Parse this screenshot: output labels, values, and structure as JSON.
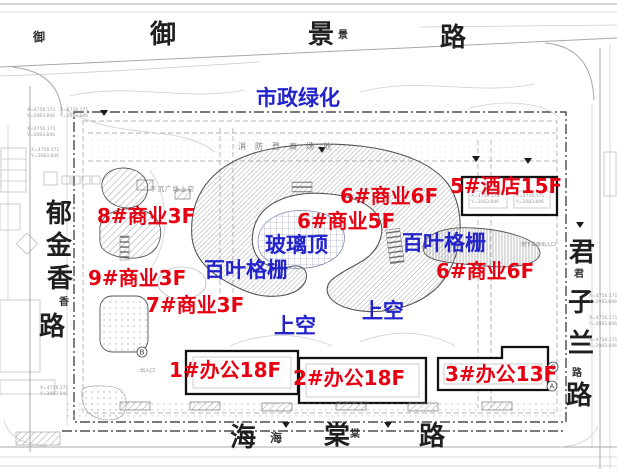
{
  "roads": {
    "top": {
      "chars": [
        "御",
        "景",
        "路"
      ],
      "small_prefix": "御",
      "small_mid": "景"
    },
    "left": {
      "chars": [
        "郁",
        "金",
        "香",
        "路"
      ],
      "small_mid": "香"
    },
    "right": {
      "chars": [
        "君",
        "子",
        "兰",
        "路"
      ],
      "small_top": "君",
      "small_bottom": "路"
    },
    "bottom": {
      "chars": [
        "海",
        "棠",
        "路"
      ],
      "small_hai": "海",
      "small_tang": "棠"
    }
  },
  "building_labels": [
    {
      "text": "8#商业3F"
    },
    {
      "text": "9#商业3F"
    },
    {
      "text": "7#商业3F"
    },
    {
      "text": "6#商业6F"
    },
    {
      "text": "6#商业5F"
    },
    {
      "text": "5#酒店15F"
    },
    {
      "text": "6#商业6F"
    },
    {
      "text": "1#办公18F"
    },
    {
      "text": "2#办公18F"
    },
    {
      "text": "3#办公13F"
    }
  ],
  "feature_labels": [
    {
      "text": "市政绿化"
    },
    {
      "text": "玻璃顶"
    },
    {
      "text": "百叶格栅"
    },
    {
      "text": "百叶格栅"
    },
    {
      "text": "上空"
    },
    {
      "text": "上空"
    }
  ],
  "annotations": {
    "fire_lane": "消防登高场地",
    "sunken_plaza": "下沉广场上空",
    "garage_entry": "地下车库出入口",
    "entry": "出入口",
    "coord_x": "X=4756.171",
    "coord_y": "Y=2083.846",
    "grid_bubbles": [
      "B",
      "C",
      "A"
    ]
  },
  "colors": {
    "building_label": "#e60012",
    "feature_label": "#2323cc",
    "boundary": "#2b2b2b",
    "linework": "#a8a8a8"
  }
}
